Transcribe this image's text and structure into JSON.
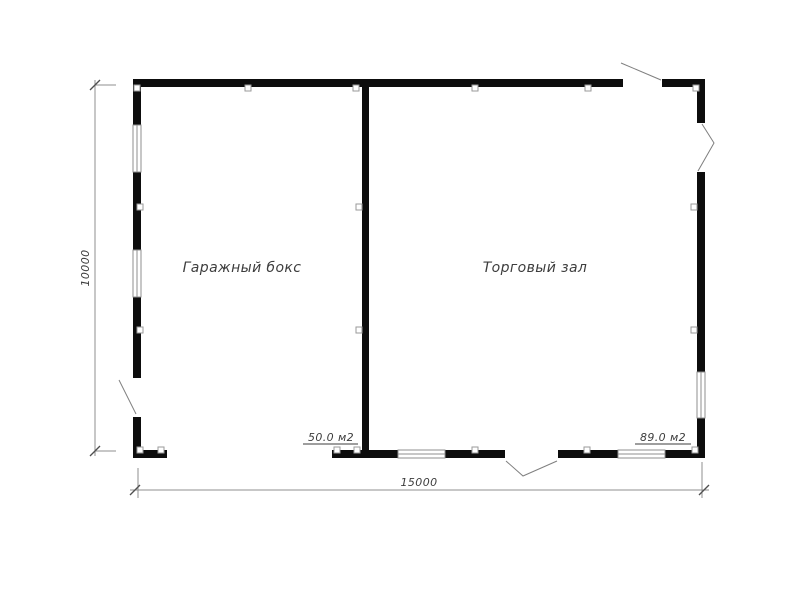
{
  "plan": {
    "rooms": [
      {
        "name": "Гаражный бокс",
        "area_label": "50.0 м2"
      },
      {
        "name": "Торговый зал",
        "area_label": "89.0 м2"
      }
    ],
    "dimension_labels": {
      "overall_width": "15000",
      "overall_height": "10000"
    },
    "colors": {
      "wall": "#0d0d0d",
      "dimension_line": "#8f8f8f",
      "annotation_text": "#3d3d3d",
      "window_line": "#8f8f8f",
      "door_leaf": "#7f7f7f",
      "marker_border": "#9a9a9a",
      "background": "#ffffff"
    }
  }
}
